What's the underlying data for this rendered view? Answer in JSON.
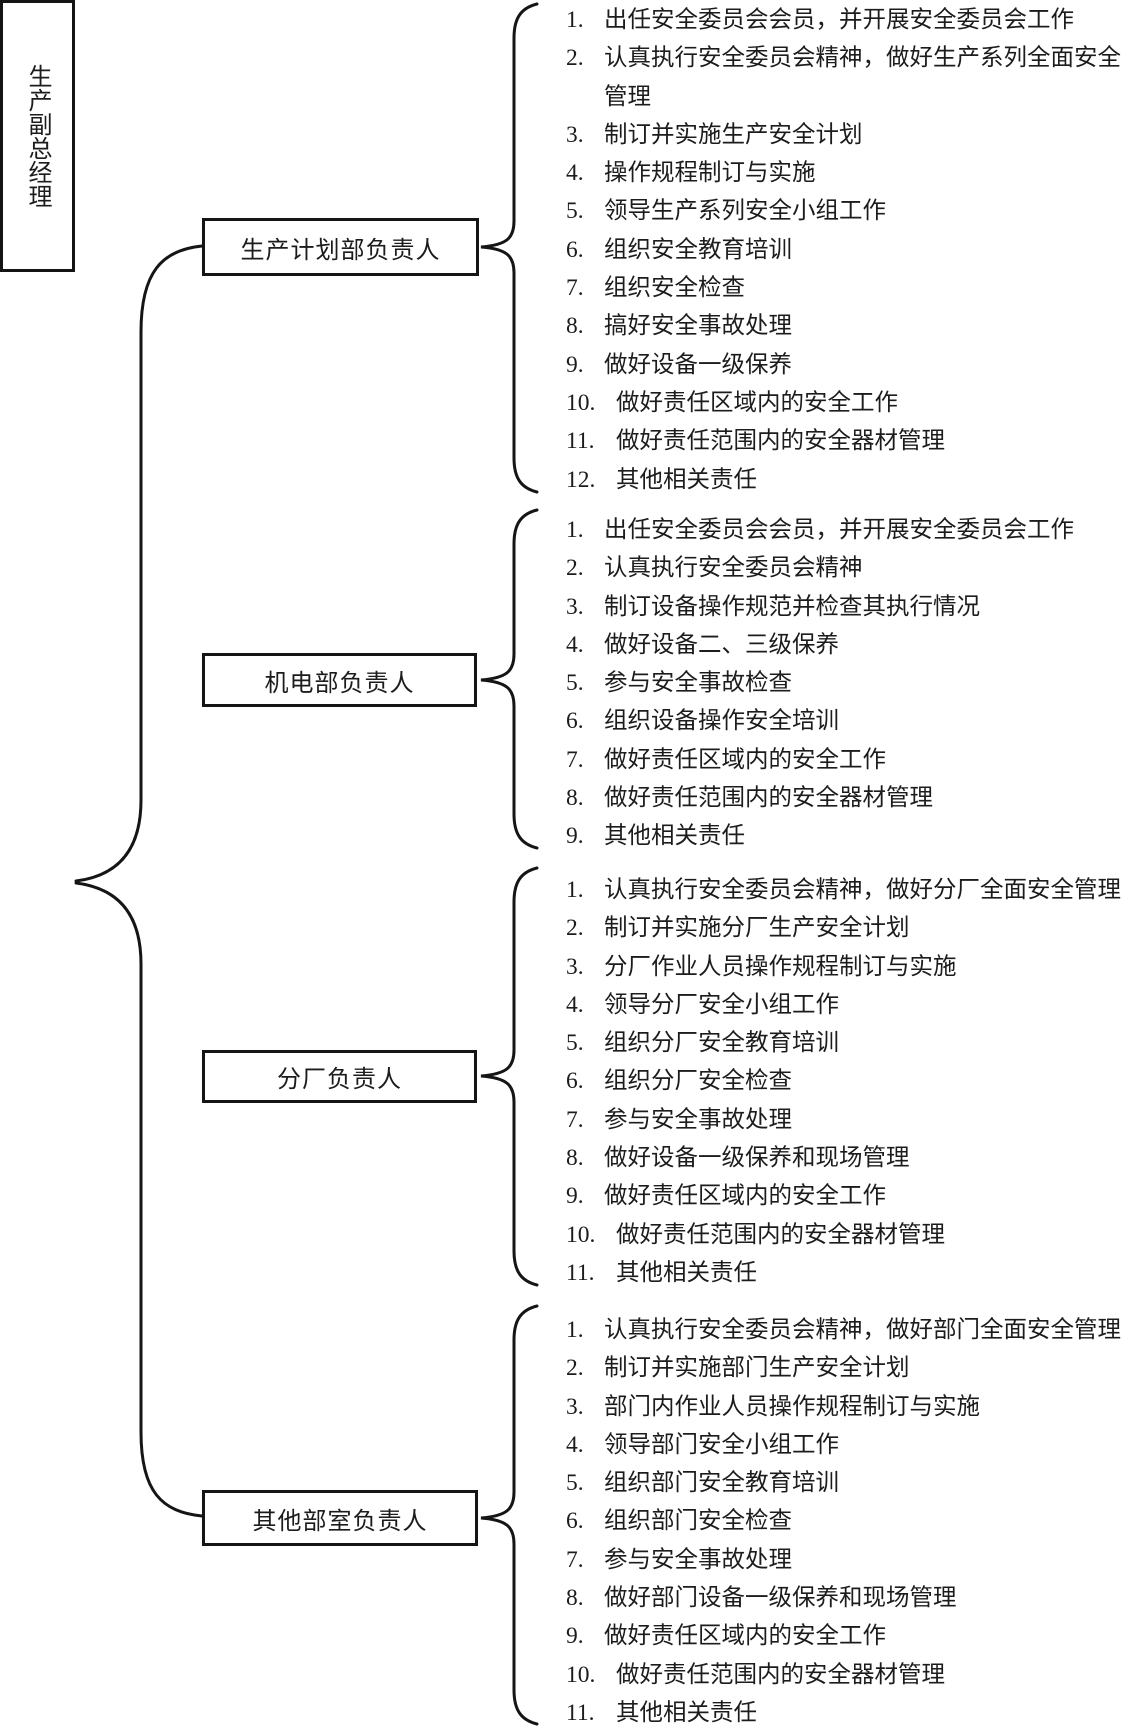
{
  "root": {
    "label": "生产副总经理"
  },
  "groups": [
    {
      "box_label": "生产计划部负责人",
      "items": [
        {
          "n": "1.",
          "text": "出任安全委员会会员，并开展安全委员会工作"
        },
        {
          "n": "2.",
          "text": "认真执行安全委员会精神，做好生产系列全面安全管理"
        },
        {
          "n": "3.",
          "text": "制订并实施生产安全计划"
        },
        {
          "n": "4.",
          "text": "操作规程制订与实施"
        },
        {
          "n": "5.",
          "text": "领导生产系列安全小组工作"
        },
        {
          "n": "6.",
          "text": "组织安全教育培训"
        },
        {
          "n": "7.",
          "text": "组织安全检查"
        },
        {
          "n": "8.",
          "text": "搞好安全事故处理"
        },
        {
          "n": "9.",
          "text": "做好设备一级保养"
        },
        {
          "n": "10.",
          "text": "做好责任区域内的安全工作"
        },
        {
          "n": "11.",
          "text": "做好责任范围内的安全器材管理"
        },
        {
          "n": "12.",
          "text": "其他相关责任"
        }
      ]
    },
    {
      "box_label": "机电部负责人",
      "items": [
        {
          "n": "1.",
          "text": "出任安全委员会会员，并开展安全委员会工作"
        },
        {
          "n": "2.",
          "text": "认真执行安全委员会精神"
        },
        {
          "n": "3.",
          "text": "制订设备操作规范并检查其执行情况"
        },
        {
          "n": "4.",
          "text": "做好设备二、三级保养"
        },
        {
          "n": "5.",
          "text": "参与安全事故检查"
        },
        {
          "n": "6.",
          "text": "组织设备操作安全培训"
        },
        {
          "n": "7.",
          "text": "做好责任区域内的安全工作"
        },
        {
          "n": "8.",
          "text": "做好责任范围内的安全器材管理"
        },
        {
          "n": "9.",
          "text": "其他相关责任"
        }
      ]
    },
    {
      "box_label": "分厂负责人",
      "items": [
        {
          "n": "1.",
          "text": "认真执行安全委员会精神，做好分厂全面安全管理"
        },
        {
          "n": "2.",
          "text": "制订并实施分厂生产安全计划"
        },
        {
          "n": "3.",
          "text": "分厂作业人员操作规程制订与实施"
        },
        {
          "n": "4.",
          "text": "领导分厂安全小组工作"
        },
        {
          "n": "5.",
          "text": "组织分厂安全教育培训"
        },
        {
          "n": "6.",
          "text": "组织分厂安全检查"
        },
        {
          "n": "7.",
          "text": "参与安全事故处理"
        },
        {
          "n": "8.",
          "text": "做好设备一级保养和现场管理"
        },
        {
          "n": "9.",
          "text": "做好责任区域内的安全工作"
        },
        {
          "n": "10.",
          "text": "做好责任范围内的安全器材管理"
        },
        {
          "n": "11.",
          "text": "其他相关责任"
        }
      ]
    },
    {
      "box_label": "其他部室负责人",
      "items": [
        {
          "n": "1.",
          "text": "认真执行安全委员会精神，做好部门全面安全管理"
        },
        {
          "n": "2.",
          "text": "制订并实施部门生产安全计划"
        },
        {
          "n": "3.",
          "text": "部门内作业人员操作规程制订与实施"
        },
        {
          "n": "4.",
          "text": "领导部门安全小组工作"
        },
        {
          "n": "5.",
          "text": "组织部门安全教育培训"
        },
        {
          "n": "6.",
          "text": "组织部门安全检查"
        },
        {
          "n": "7.",
          "text": "参与安全事故处理"
        },
        {
          "n": "8.",
          "text": "做好部门设备一级保养和现场管理"
        },
        {
          "n": "9.",
          "text": "做好责任区域内的安全工作"
        },
        {
          "n": "10.",
          "text": "做好责任范围内的安全器材管理"
        },
        {
          "n": "11.",
          "text": "其他相关责任"
        }
      ]
    }
  ],
  "colors": {
    "ink": "#151515",
    "background": "#ffffff"
  }
}
